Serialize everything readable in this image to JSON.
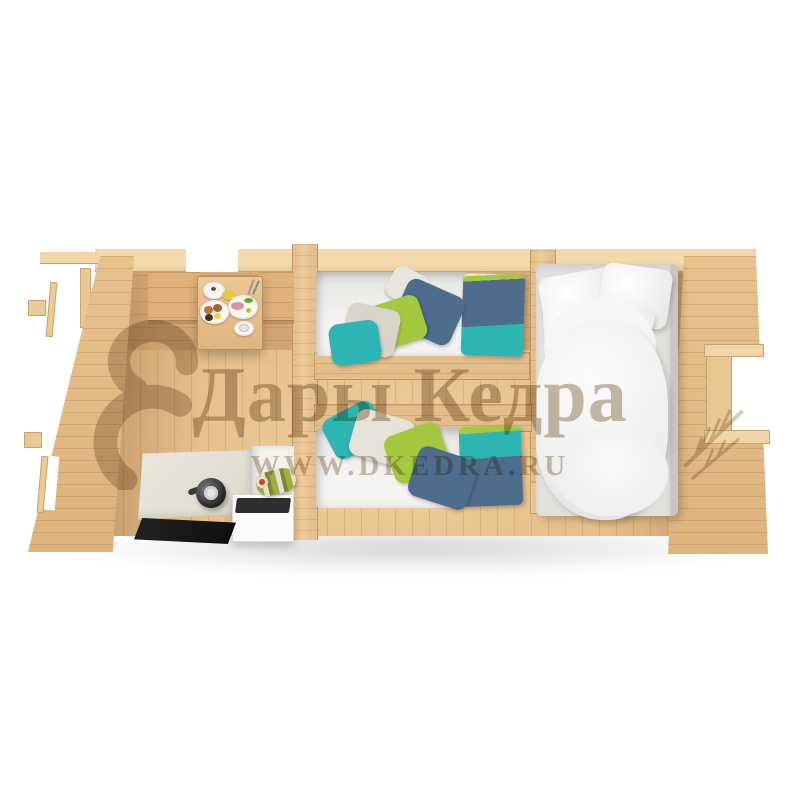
{
  "watermark": {
    "brand": "Дары Кедра",
    "url": "WWW.DKEDRA.RU"
  },
  "scene": {
    "subject": "Top-down 3D cutaway render of a three-room wooden cabin interior",
    "rooms": [
      {
        "id": "dining-kitchen",
        "furniture": [
          "breakfast-table-with-plates",
          "wall-bench",
          "kitchen-counter",
          "kettle",
          "stove-cabinet",
          "striped-roll",
          "black-floor-mat"
        ]
      },
      {
        "id": "twin-bedroom",
        "furniture": [
          "single-bed-upper",
          "single-bed-lower",
          "color-pillows",
          "color-blankets"
        ]
      },
      {
        "id": "double-bedroom",
        "furniture": [
          "double-bed",
          "white-pillows",
          "white-duvet"
        ]
      }
    ],
    "openings": [
      "back-door-opening",
      "right-wall-window",
      "left-wall-openings"
    ]
  },
  "theme": {
    "woodTop": "#f4d9ab",
    "woodWall": "#d8ad7a",
    "woodFloor": "#e2b984",
    "woodFloorLight": "#efcf9d",
    "woodPartition": "#eecb9b",
    "woodExterior": "#e7c28c",
    "woodBench": "#ddb07c",
    "teal": "#2cb5b3",
    "green": "#a4c940",
    "blue": "#4e6c8c",
    "bedding": "#f3f3f3",
    "counter": "#e6e3d9",
    "mat": "#2e2e2e",
    "cabinet": "#fbfbfb",
    "watermark": "#a08c6e"
  }
}
